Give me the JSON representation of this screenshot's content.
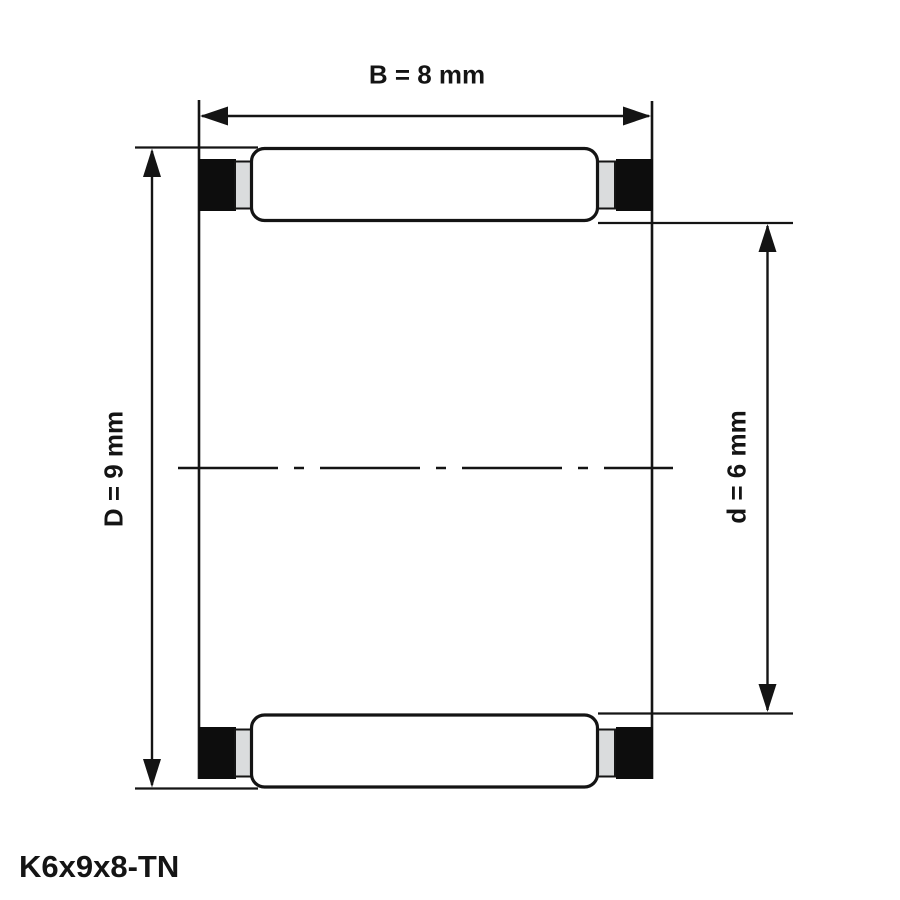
{
  "figure": {
    "part_label": "K6x9x8-TN",
    "dimensions": {
      "width_b": "B = 8 mm",
      "outer_diameter_D": "D = 9 mm",
      "inner_diameter_d": "d = 6 mm"
    },
    "colors": {
      "line": "#141414",
      "cage_fill": "#0d0d0d",
      "ring_fill": "#dadcdd",
      "background": "#ffffff"
    }
  }
}
